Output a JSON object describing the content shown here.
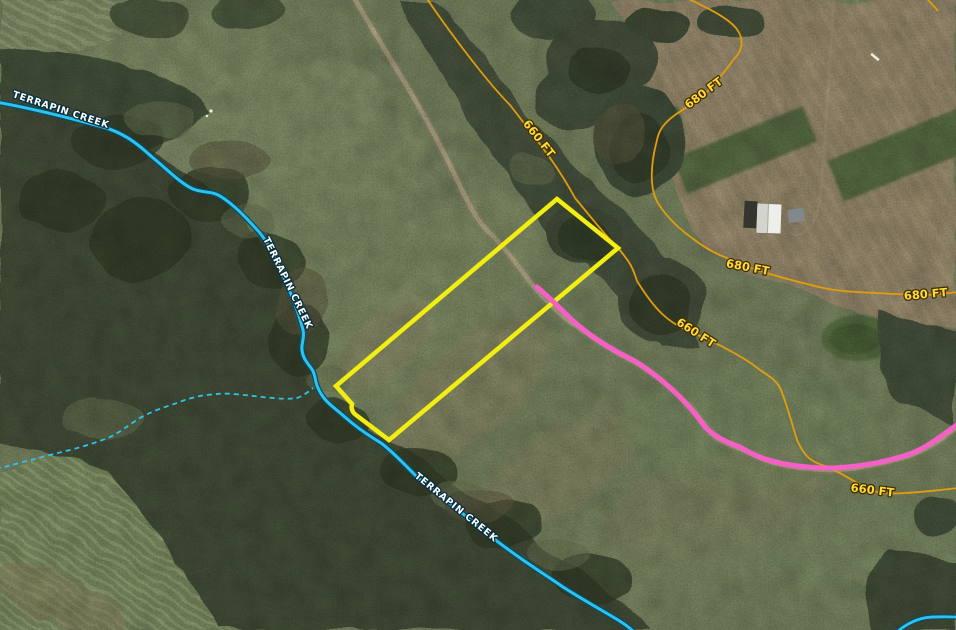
{
  "map": {
    "description": "Aerial satellite parcel map with creek, elevation contours, parcel boundary and highlighted route",
    "labels": {
      "creek": [
        {
          "text": "TERRAPIN CREEK"
        },
        {
          "text": "TERRAPIN CREEK"
        },
        {
          "text": "TERRAPIN CREEK"
        }
      ],
      "contours": [
        {
          "text": "660 FT"
        },
        {
          "text": "660 FT"
        },
        {
          "text": "660 FT"
        },
        {
          "text": "680 FT"
        },
        {
          "text": "680 FT"
        },
        {
          "text": "680 FT"
        }
      ]
    },
    "feature_colors": {
      "parcel_boundary": "#f2ee0f",
      "route_highlight": "#f660c6",
      "creek_line": "#2cc4ef",
      "contour_line": "#e29d0b",
      "creek_label_fill": "#ffffff",
      "contour_label_fill": "#ffd935"
    }
  }
}
